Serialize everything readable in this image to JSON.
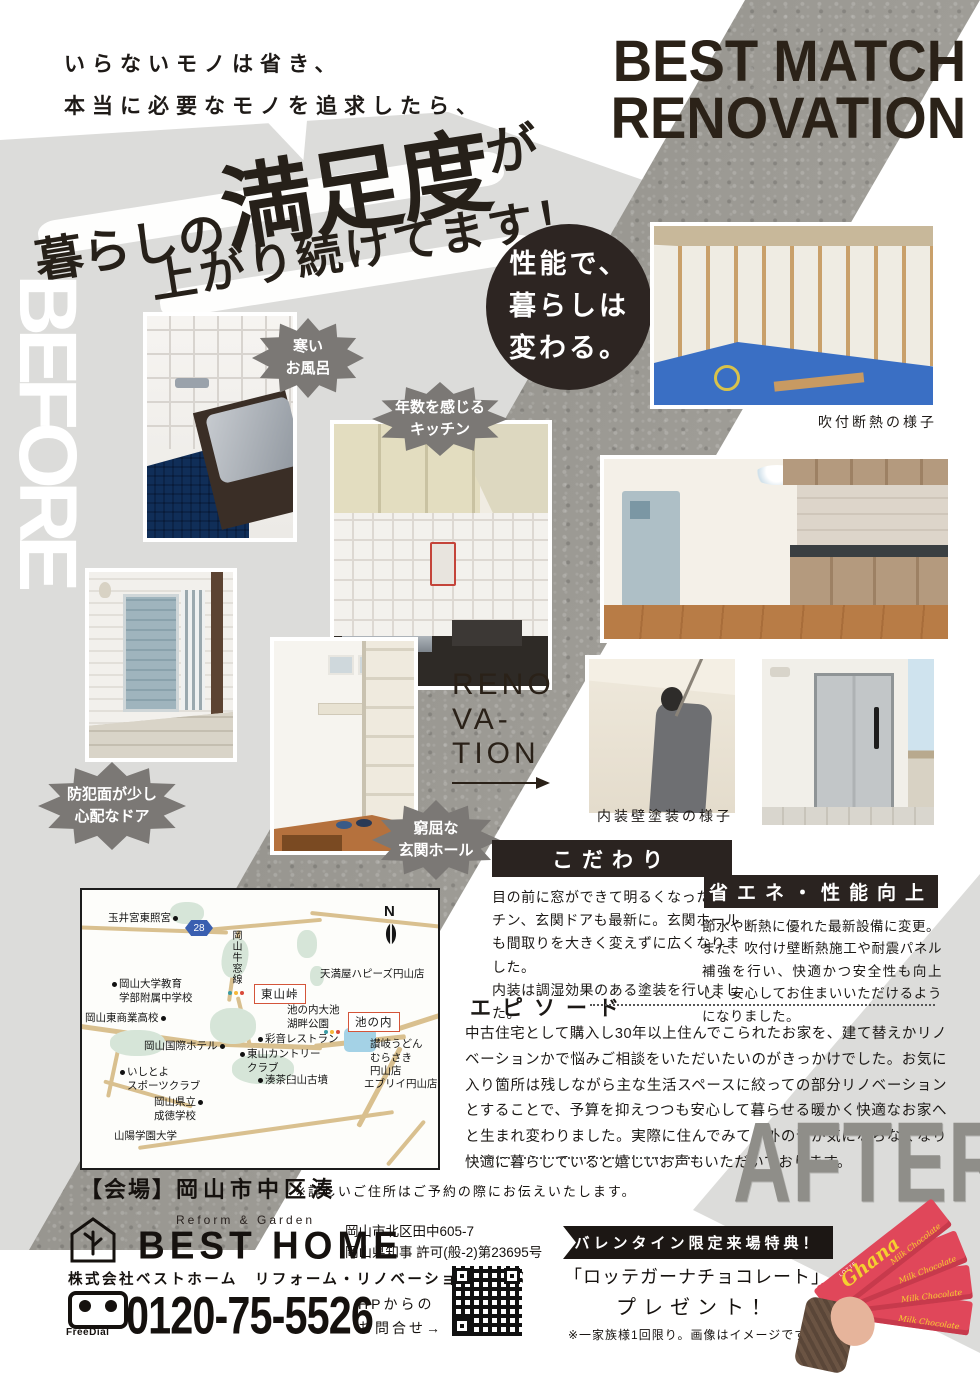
{
  "intro": {
    "line1_pre": "いらない",
    "line1_emph": "モノ",
    "line1_post": "は省き、",
    "line2_pre": "本当に必要な",
    "line2_emph": "モノ",
    "line2_post": "を追求したら、"
  },
  "headline": {
    "seg1": "暮らしの",
    "seg2": "満足度",
    "seg3": "が",
    "line2": "上がり続けてます！"
  },
  "title": {
    "line1": "BEST MATCH",
    "line2": "RENOVATION"
  },
  "labels": {
    "before": "BEFORE",
    "after": "AFTER",
    "reno_l1": "RENO",
    "reno_l2": "VA-",
    "reno_l3": "TION"
  },
  "circle_badge": {
    "text": "性能で、\n暮らしは\n変わる。"
  },
  "bubbles": {
    "bath": "寒い\nお風呂",
    "kitchen": "年数を感じる\nキッチン",
    "door": "防犯面が少し\n心配なドア",
    "hall": "窮屈な\n玄関ホール"
  },
  "captions": {
    "insulation": "吹付断熱の様子",
    "painting": "内装壁塗装の様子"
  },
  "sections": {
    "kodawari": {
      "title": "こだわり",
      "body": "目の前に窓ができて明るくなったキッチン、玄関ドアも最新に。玄関ホールも間取りを大きく変えずに広くなりました。\n内装は調湿効果のある塗装を行いました。"
    },
    "shoene": {
      "title": "省エネ・性能向上",
      "body": "節水や断熱に優れた最新設備に変更。\nまた、吹付け壁断熱施工や耐震パネル補強を行い、快適かつ安全性も向上し、安心してお住まいいただけるようになりました。"
    },
    "episode": {
      "title": "エピソード",
      "body": "中古住宅として購入し30年以上住んでこられたお家を、建て替えかリノベーションかで悩みご相談をいただいたいのがきっかけでした。お気に入り箇所は残しながら主な生活スペースに絞っての部分リノベーションとすることで、予算を抑えつつも安心して暮らせる暖かく快適なお家へと生まれ変わりました。実際に住んでみて、外の音が気にならなくなり快適に暮らしていると嬉しいお声もいただいております。"
    }
  },
  "map": {
    "compass": "N",
    "route_badge": "28",
    "road_name": "岡山牛窓線",
    "boxed": [
      "東山峠",
      "池の内"
    ],
    "places": [
      "玉井宮東照宮",
      "岡山大学教育\n学部附属中学校",
      "岡山東商業高校",
      "天満屋ハピーズ円山店",
      "池の内大池\n湖畔公園",
      "彩音レストラン",
      "東山カントリー\nクラブ",
      "讃岐うどん\nむらさき\n円山店",
      "エブリイ円山店",
      "岡山国際ホテル",
      "いしとよ\nスポーツクラブ",
      "湊茶臼山古墳",
      "岡山県立\n成徳学校",
      "山陽学園大学"
    ]
  },
  "venue": {
    "label": "【会場】",
    "name": "岡山市中区湊",
    "note": "※詳しいご住所はご予約の際にお伝えいたします。"
  },
  "footer": {
    "tagline": "Reform & Garden",
    "brand": "BEST HOME",
    "address1": "岡山市北区田中605-7",
    "address2": "岡山県知事 許可(般-2)第23695号",
    "company": "株式会社ベストホーム　リフォーム・リノベーション事業部",
    "freedial": "FreeDial",
    "phone": "0120-75-5526",
    "hp": "HPからの\nお問合せ→"
  },
  "valentine": {
    "banner": "バレンタイン限定来場特典！",
    "line1": "「ロッテガーナチョコレート」",
    "line2": "プレゼント！",
    "note": "※一家族様1回限り。画像はイメージです。",
    "choco_brand": "Ghana",
    "choco_maker": "LOTTE",
    "choco_sub": "Milk Chocolate"
  },
  "colors": {
    "accent_dark": "#2a2320",
    "bubble_gray": "#7b7875",
    "band_gray": "#dcdcda",
    "concrete": "#9c9a96",
    "map_box_border": "#d4553a",
    "ghana_red": "#e0475a"
  }
}
